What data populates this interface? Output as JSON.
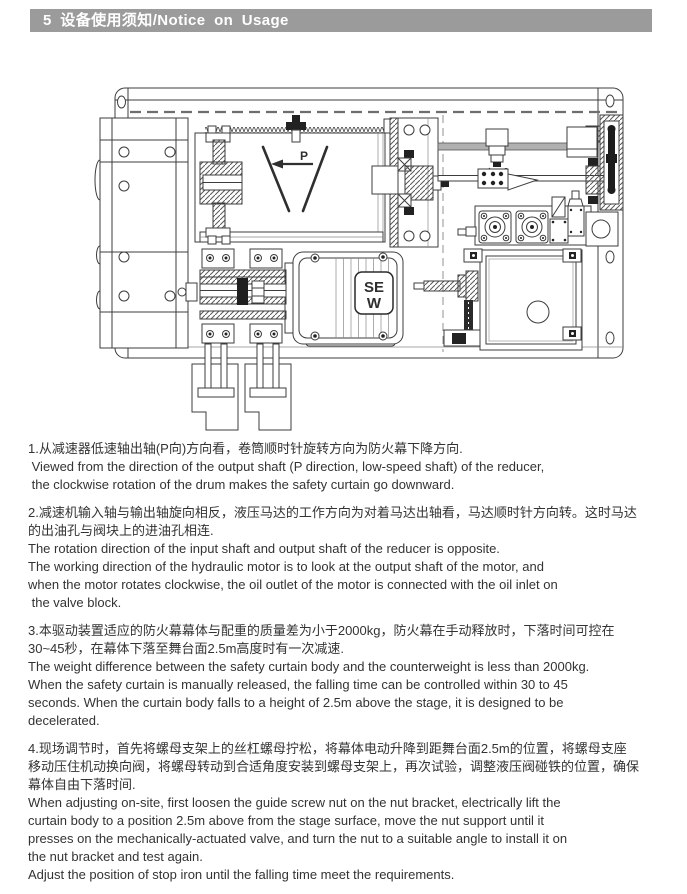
{
  "header": {
    "title": "5  设备使用须知/Notice on Usage"
  },
  "figure": {
    "p_label": "P",
    "motor_logo_line1": "SE",
    "motor_logo_line2": "W"
  },
  "notes": [
    {
      "text": "1.从减速器低速轴出轴(P向)方向看，卷筒顺时针旋转方向为防火幕下降方向.\n Viewed from the direction of the output shaft (P direction, low-speed shaft) of the reducer,\n the clockwise rotation of the drum makes the safety curtain go downward."
    },
    {
      "text": "2.减速机输入轴与输出轴旋向相反，液压马达的工作方向为对着马达出轴看，马达顺时针方向转。这时马达\n的出油孔与阀块上的进油孔相连.\nThe rotation direction of the input shaft and output shaft of the reducer is opposite.\nThe working direction of the hydraulic motor is to look at the output shaft of the motor, and\nwhen the motor rotates clockwise, the oil outlet of the motor is connected with the oil inlet on\n the valve block."
    },
    {
      "text": "3.本驱动装置适应的防火幕幕体与配重的质量差为小于2000kg，防火幕在手动释放时，下落时间可控在\n30~45秒，在幕体下落至舞台面2.5m高度时有一次减速.\nThe weight difference between the safety curtain body and the counterweight is less than 2000kg.\nWhen the safety curtain is manually released, the falling time can be controlled within 30 to 45\nseconds. When the curtain body falls to a height of 2.5m above the stage, it is designed to be\ndecelerated."
    },
    {
      "text": "4.现场调节时，首先将螺母支架上的丝杠螺母拧松，将幕体电动升降到距舞台面2.5m的位置，将螺母支座\n移动压住机动换向阀，将螺母转动到合适角度安装到螺母支架上，再次试验，调整液压阀碰铁的位置，确保\n幕体自由下落时间.\nWhen adjusting on-site, first loosen the guide screw nut on the nut bracket, electrically lift the\ncurtain body to a position 2.5m above from the stage surface, move the nut support until it\npresses on the mechanically-actuated valve, and turn the nut to a suitable angle to install it on\nthe nut bracket and test again.\nAdjust the position of stop iron until the falling time meet the requirements."
    }
  ]
}
